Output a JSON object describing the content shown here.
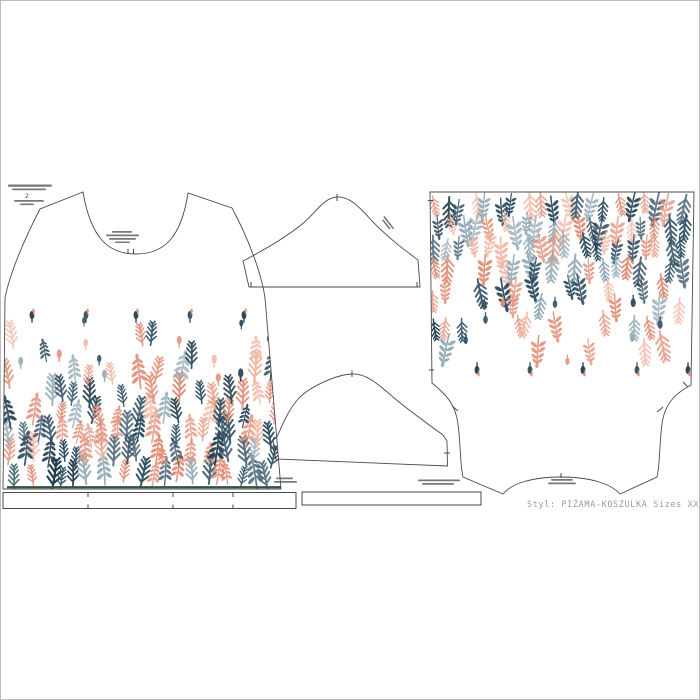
{
  "footer": {
    "style_label": "Styl: PIŻAMA-KOSZULKA  Sizes XXL"
  },
  "corner_block": {
    "mark": "2"
  },
  "print": {
    "palette": {
      "coral": "#e2917b",
      "coral_light": "#f2b9a6",
      "navy": "#305064",
      "navy_dark": "#223c4d",
      "steel": "#93aab6",
      "hem_green": "#33523f",
      "outline_gray": "#4a4a4a",
      "caption_gray": "#9b9b9b"
    },
    "front_region": {
      "x0": 10,
      "x1": 276,
      "y_dense": 484,
      "y_fade": 312,
      "bud_row_y": 321,
      "bud_xs": [
        32,
        86,
        136,
        190,
        244
      ]
    },
    "back_region": {
      "x0": 436,
      "x1": 688,
      "y_dense": 196,
      "y_fade": 372,
      "bud_row_y": 364,
      "bud_xs": [
        477,
        530,
        583,
        637,
        688
      ]
    }
  }
}
